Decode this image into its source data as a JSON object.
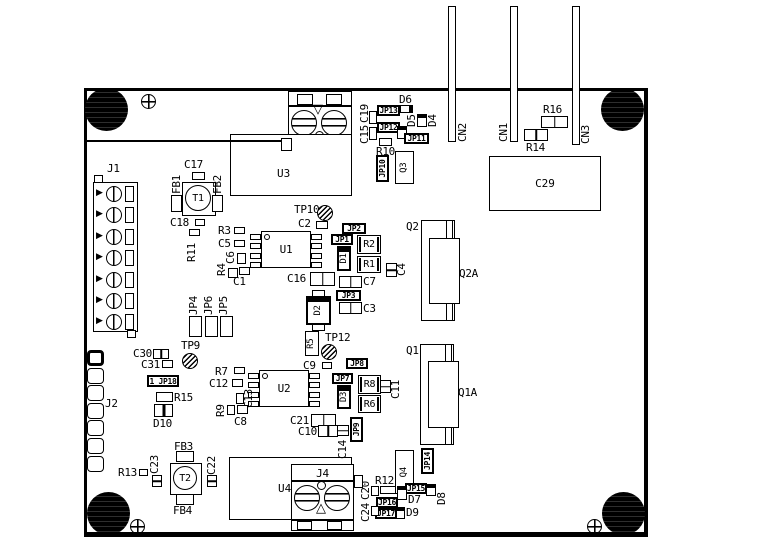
{
  "title": "PCB assembly drawing",
  "colors": {
    "ink": "#000000",
    "background": "#ffffff"
  },
  "designators": {
    "j1": "J1",
    "j2": "J2",
    "j3": "J3",
    "j4": "J4",
    "u1": "U1",
    "u2": "U2",
    "u3": "U3",
    "u4": "U4",
    "t1": "T1",
    "t2": "T2",
    "c29": "C29"
  },
  "parts": [
    {
      "n": "trace-to-j3",
      "k": "hline",
      "x": 84,
      "y": 140,
      "w": 198,
      "h": 2
    },
    {
      "n": "cn2-pin",
      "k": "rect",
      "x": 448,
      "y": 6,
      "w": 8,
      "h": 136
    },
    {
      "n": "cn2-label",
      "k": "vlbl",
      "t": "CN2",
      "x": 457,
      "y": 118,
      "w": 11,
      "h": 24
    },
    {
      "n": "cn1-pin",
      "k": "rect",
      "x": 510,
      "y": 6,
      "w": 8,
      "h": 136
    },
    {
      "n": "cn1-label",
      "k": "vlbl",
      "t": "CN1",
      "x": 498,
      "y": 118,
      "w": 11,
      "h": 24
    },
    {
      "n": "cn3-pin",
      "k": "rect",
      "x": 572,
      "y": 6,
      "w": 8,
      "h": 139
    },
    {
      "n": "cn3-label",
      "k": "vlbl",
      "t": "CN3",
      "x": 580,
      "y": 120,
      "w": 11,
      "h": 24
    },
    {
      "n": "r16-label",
      "k": "lbl",
      "t": "R16",
      "x": 543,
      "y": 104
    },
    {
      "n": "r16-body",
      "k": "cap",
      "x": 541,
      "y": 116,
      "w": 27,
      "h": 12
    },
    {
      "n": "r14-body",
      "k": "cap",
      "x": 524,
      "y": 129,
      "w": 24,
      "h": 12
    },
    {
      "n": "r14-label",
      "k": "lbl",
      "t": "R14",
      "x": 526,
      "y": 142
    },
    {
      "n": "c19-label",
      "k": "vlbl",
      "t": "C19",
      "x": 359,
      "y": 103,
      "w": 11,
      "h": 20
    },
    {
      "n": "c15-label",
      "k": "vlbl",
      "t": "C15",
      "x": 359,
      "y": 124,
      "w": 11,
      "h": 20
    },
    {
      "n": "c19-body",
      "k": "rect",
      "x": 369,
      "y": 111,
      "w": 8,
      "h": 13
    },
    {
      "n": "c15-body",
      "k": "rect",
      "x": 369,
      "y": 127,
      "w": 8,
      "h": 13
    },
    {
      "n": "jp13",
      "k": "jp",
      "t": "JP13",
      "x": 377,
      "y": 105,
      "w": 23,
      "h": 11
    },
    {
      "n": "jp12",
      "k": "jp",
      "t": "JP12",
      "x": 377,
      "y": 122,
      "w": 23,
      "h": 11
    },
    {
      "n": "d6-label",
      "k": "lbl",
      "t": "D6",
      "x": 399,
      "y": 94
    },
    {
      "n": "d6-body",
      "k": "dih",
      "x": 400,
      "y": 105,
      "w": 13,
      "h": 8
    },
    {
      "n": "d5-body",
      "k": "di",
      "x": 397,
      "y": 126,
      "w": 10,
      "h": 13
    },
    {
      "n": "d5-label",
      "k": "vlbl",
      "t": "D5",
      "x": 406,
      "y": 111,
      "w": 11,
      "h": 16
    },
    {
      "n": "d4-body",
      "k": "di",
      "x": 417,
      "y": 114,
      "w": 10,
      "h": 13
    },
    {
      "n": "d4-label",
      "k": "vlbl",
      "t": "D4",
      "x": 427,
      "y": 111,
      "w": 11,
      "h": 16
    },
    {
      "n": "jp11",
      "k": "jp",
      "t": "JP11",
      "x": 404,
      "y": 133,
      "w": 25,
      "h": 11
    },
    {
      "n": "r10-body",
      "k": "rect",
      "x": 379,
      "y": 138,
      "w": 13,
      "h": 8
    },
    {
      "n": "r10-label",
      "k": "lbl",
      "t": "R10",
      "x": 376,
      "y": 146
    },
    {
      "n": "jp10",
      "k": "vjp",
      "t": "JP10",
      "x": 376,
      "y": 155,
      "w": 13,
      "h": 27
    },
    {
      "n": "q3",
      "k": "vbox",
      "t": "Q3",
      "x": 395,
      "y": 151,
      "w": 19,
      "h": 33
    },
    {
      "n": "j3-pin-left",
      "k": "rect",
      "x": 281,
      "y": 138,
      "w": 11,
      "h": 13
    },
    {
      "n": "c17-label",
      "k": "lbl",
      "t": "C17",
      "x": 184,
      "y": 159
    },
    {
      "n": "c17-body",
      "k": "rect",
      "x": 192,
      "y": 172,
      "w": 13,
      "h": 8
    },
    {
      "n": "fb1-label",
      "k": "vlbl",
      "t": "FB1",
      "x": 171,
      "y": 170,
      "w": 11,
      "h": 24
    },
    {
      "n": "fb1-body",
      "k": "rect",
      "x": 171,
      "y": 195,
      "w": 11,
      "h": 17
    },
    {
      "n": "fb2-label",
      "k": "vlbl",
      "t": "FB2",
      "x": 212,
      "y": 170,
      "w": 11,
      "h": 24
    },
    {
      "n": "fb2-body",
      "k": "rect",
      "x": 212,
      "y": 195,
      "w": 11,
      "h": 17
    },
    {
      "n": "c18-label",
      "k": "lbl",
      "t": "C18",
      "x": 170,
      "y": 217
    },
    {
      "n": "c18-body",
      "k": "rect",
      "x": 195,
      "y": 219,
      "w": 10,
      "h": 7
    },
    {
      "n": "r11-body",
      "k": "rect",
      "x": 189,
      "y": 229,
      "w": 11,
      "h": 7
    },
    {
      "n": "r11-label",
      "k": "vlbl",
      "t": "R11",
      "x": 186,
      "y": 238,
      "w": 11,
      "h": 24
    },
    {
      "n": "j1-label",
      "k": "lbl",
      "t": "J1",
      "x": 107,
      "y": 163
    },
    {
      "n": "j1-stub-top",
      "k": "rect",
      "x": 94,
      "y": 175,
      "w": 9,
      "h": 8
    },
    {
      "n": "j1-stub-bottom",
      "k": "rect",
      "x": 127,
      "y": 330,
      "w": 9,
      "h": 8
    },
    {
      "n": "r3-label",
      "k": "lbl",
      "t": "R3",
      "x": 218,
      "y": 225
    },
    {
      "n": "r3-body",
      "k": "rect",
      "x": 234,
      "y": 227,
      "w": 11,
      "h": 7
    },
    {
      "n": "c5-label",
      "k": "lbl",
      "t": "C5",
      "x": 218,
      "y": 238
    },
    {
      "n": "c5-body",
      "k": "rect",
      "x": 234,
      "y": 240,
      "w": 11,
      "h": 7
    },
    {
      "n": "c6-label",
      "k": "vlbl",
      "t": "C6",
      "x": 225,
      "y": 249,
      "w": 11,
      "h": 15
    },
    {
      "n": "c6-body",
      "k": "rect",
      "x": 237,
      "y": 253,
      "w": 9,
      "h": 11
    },
    {
      "n": "r4-label",
      "k": "vlbl",
      "t": "R4",
      "x": 216,
      "y": 261,
      "w": 11,
      "h": 15
    },
    {
      "n": "r4-body",
      "k": "rect",
      "x": 228,
      "y": 268,
      "w": 10,
      "h": 10
    },
    {
      "n": "c1-body",
      "k": "rect",
      "x": 239,
      "y": 267,
      "w": 11,
      "h": 8
    },
    {
      "n": "c1-label",
      "k": "lbl",
      "t": "C1",
      "x": 233,
      "y": 276
    },
    {
      "n": "jp4-label",
      "k": "vlbl",
      "t": "JP4",
      "x": 188,
      "y": 291,
      "w": 11,
      "h": 24
    },
    {
      "n": "jp6-label",
      "k": "vlbl",
      "t": "JP6",
      "x": 203,
      "y": 291,
      "w": 11,
      "h": 24
    },
    {
      "n": "jp5-label",
      "k": "vlbl",
      "t": "JP5",
      "x": 218,
      "y": 291,
      "w": 11,
      "h": 24
    },
    {
      "n": "jp4-body",
      "k": "rect",
      "x": 189,
      "y": 316,
      "w": 13,
      "h": 21
    },
    {
      "n": "jp6-body",
      "k": "rect",
      "x": 205,
      "y": 316,
      "w": 13,
      "h": 21
    },
    {
      "n": "jp5-body",
      "k": "rect",
      "x": 220,
      "y": 316,
      "w": 13,
      "h": 21
    },
    {
      "n": "tp10-label",
      "k": "lbl",
      "t": "TP10",
      "x": 294,
      "y": 204
    },
    {
      "n": "tp10",
      "k": "tp",
      "x": 317,
      "y": 205,
      "w": 16,
      "h": 16
    },
    {
      "n": "c2-label",
      "k": "lbl",
      "t": "C2",
      "x": 298,
      "y": 218
    },
    {
      "n": "c2-body",
      "k": "rect",
      "x": 316,
      "y": 221,
      "w": 12,
      "h": 8
    },
    {
      "n": "jp2",
      "k": "jp",
      "t": "JP2",
      "x": 342,
      "y": 223,
      "w": 24,
      "h": 11
    },
    {
      "n": "jp1",
      "k": "jp",
      "t": "JP1",
      "x": 331,
      "y": 234,
      "w": 22,
      "h": 11
    },
    {
      "n": "r2",
      "k": "box",
      "t": "R2",
      "x": 357,
      "y": 235,
      "w": 24,
      "h": 19
    },
    {
      "n": "d1",
      "k": "dbox",
      "t": "D1",
      "x": 337,
      "y": 246,
      "w": 14,
      "h": 25
    },
    {
      "n": "r1",
      "k": "box",
      "t": "R1",
      "x": 357,
      "y": 256,
      "w": 24,
      "h": 17
    },
    {
      "n": "c4-body",
      "k": "vcap",
      "x": 386,
      "y": 263,
      "w": 11,
      "h": 14
    },
    {
      "n": "c4-label",
      "k": "vlbl",
      "t": "C4",
      "x": 396,
      "y": 260,
      "w": 11,
      "h": 16
    },
    {
      "n": "q2-label",
      "k": "lbl",
      "t": "Q2",
      "x": 406,
      "y": 221
    },
    {
      "n": "q2-body",
      "k": "rect",
      "x": 421,
      "y": 220,
      "w": 34,
      "h": 101
    },
    {
      "n": "q2-rails",
      "k": "rails",
      "x": 446,
      "y": 220,
      "w": 7,
      "h": 101
    },
    {
      "n": "q2a-body",
      "k": "rect",
      "x": 429,
      "y": 238,
      "w": 31,
      "h": 66
    },
    {
      "n": "q2a-label",
      "k": "lbl",
      "t": "Q2A",
      "x": 459,
      "y": 268
    },
    {
      "n": "c16-label",
      "k": "lbl",
      "t": "C16",
      "x": 287,
      "y": 273
    },
    {
      "n": "c16-body",
      "k": "cap",
      "x": 310,
      "y": 272,
      "w": 25,
      "h": 14
    },
    {
      "n": "c7-body",
      "k": "cap",
      "x": 339,
      "y": 276,
      "w": 23,
      "h": 12
    },
    {
      "n": "c7-label",
      "k": "lbl",
      "t": "C7",
      "x": 363,
      "y": 276
    },
    {
      "n": "jp3",
      "k": "jp",
      "t": "JP3",
      "x": 336,
      "y": 290,
      "w": 25,
      "h": 11
    },
    {
      "n": "c3-body",
      "k": "cap",
      "x": 339,
      "y": 302,
      "w": 23,
      "h": 12
    },
    {
      "n": "c3-label",
      "k": "lbl",
      "t": "C3",
      "x": 363,
      "y": 303
    },
    {
      "n": "d2-pad-top",
      "k": "rect",
      "x": 312,
      "y": 290,
      "w": 13,
      "h": 7
    },
    {
      "n": "d2",
      "k": "dbox",
      "t": "D2",
      "x": 306,
      "y": 296,
      "w": 25,
      "h": 29
    },
    {
      "n": "d2-pad-bottom",
      "k": "rect",
      "x": 312,
      "y": 324,
      "w": 13,
      "h": 7
    },
    {
      "n": "r5",
      "k": "vbox",
      "t": "R5",
      "x": 305,
      "y": 331,
      "w": 14,
      "h": 25
    },
    {
      "n": "tp12-label",
      "k": "lbl",
      "t": "TP12",
      "x": 325,
      "y": 332
    },
    {
      "n": "tp12",
      "k": "tp",
      "x": 321,
      "y": 344,
      "w": 16,
      "h": 16
    },
    {
      "n": "tp9-label",
      "k": "lbl",
      "t": "TP9",
      "x": 181,
      "y": 340
    },
    {
      "n": "tp9",
      "k": "tp",
      "x": 182,
      "y": 353,
      "w": 16,
      "h": 16
    },
    {
      "n": "c30-label",
      "k": "lbl",
      "t": "C30",
      "x": 133,
      "y": 348
    },
    {
      "n": "c30-body",
      "k": "cap",
      "x": 153,
      "y": 349,
      "w": 16,
      "h": 10
    },
    {
      "n": "c31-label",
      "k": "lbl",
      "t": "C31",
      "x": 141,
      "y": 359
    },
    {
      "n": "c31-body",
      "k": "rect",
      "x": 162,
      "y": 360,
      "w": 11,
      "h": 8
    },
    {
      "n": "jp18",
      "k": "jp",
      "t": "1 JP18",
      "x": 147,
      "y": 375,
      "w": 32,
      "h": 12
    },
    {
      "n": "r15-body",
      "k": "rect",
      "x": 156,
      "y": 392,
      "w": 17,
      "h": 10
    },
    {
      "n": "r15-label",
      "k": "lbl",
      "t": "R15",
      "x": 174,
      "y": 392
    },
    {
      "n": "d10-body",
      "k": "dcap",
      "x": 154,
      "y": 404,
      "w": 19,
      "h": 13
    },
    {
      "n": "d10-label",
      "k": "lbl",
      "t": "D10",
      "x": 153,
      "y": 418
    },
    {
      "n": "j2-label",
      "k": "lbl",
      "t": "J2",
      "x": 105,
      "y": 398
    },
    {
      "n": "r7-label",
      "k": "lbl",
      "t": "R7",
      "x": 215,
      "y": 366
    },
    {
      "n": "r7-body",
      "k": "rect",
      "x": 234,
      "y": 367,
      "w": 11,
      "h": 7
    },
    {
      "n": "c12-label",
      "k": "lbl",
      "t": "C12",
      "x": 209,
      "y": 378
    },
    {
      "n": "c12-body",
      "k": "rect",
      "x": 232,
      "y": 379,
      "w": 11,
      "h": 8
    },
    {
      "n": "c13-body",
      "k": "rect",
      "x": 236,
      "y": 393,
      "w": 8,
      "h": 11
    },
    {
      "n": "c13-label",
      "k": "vlbl",
      "t": "C13",
      "x": 243,
      "y": 386,
      "w": 11,
      "h": 22
    },
    {
      "n": "r9-label",
      "k": "vlbl",
      "t": "R9",
      "x": 215,
      "y": 402,
      "w": 11,
      "h": 15
    },
    {
      "n": "r9-body",
      "k": "rect",
      "x": 227,
      "y": 405,
      "w": 8,
      "h": 10
    },
    {
      "n": "c8-body",
      "k": "rect",
      "x": 237,
      "y": 405,
      "w": 11,
      "h": 9
    },
    {
      "n": "c8-label",
      "k": "lbl",
      "t": "C8",
      "x": 234,
      "y": 416
    },
    {
      "n": "c9-label",
      "k": "lbl",
      "t": "C9",
      "x": 303,
      "y": 360
    },
    {
      "n": "c9-body",
      "k": "rect",
      "x": 322,
      "y": 362,
      "w": 10,
      "h": 7
    },
    {
      "n": "jp8",
      "k": "jp",
      "t": "JP8",
      "x": 346,
      "y": 358,
      "w": 22,
      "h": 11
    },
    {
      "n": "jp7",
      "k": "jp",
      "t": "JP7",
      "x": 332,
      "y": 373,
      "w": 21,
      "h": 11
    },
    {
      "n": "r8",
      "k": "box",
      "t": "R8",
      "x": 358,
      "y": 375,
      "w": 23,
      "h": 19
    },
    {
      "n": "d3",
      "k": "dbox",
      "t": "D3",
      "x": 337,
      "y": 385,
      "w": 14,
      "h": 24
    },
    {
      "n": "r6",
      "k": "box",
      "t": "R6",
      "x": 358,
      "y": 395,
      "w": 23,
      "h": 18
    },
    {
      "n": "c11-body",
      "k": "vcap",
      "x": 380,
      "y": 380,
      "w": 11,
      "h": 13
    },
    {
      "n": "c11-label",
      "k": "vlbl",
      "t": "C11",
      "x": 390,
      "y": 379,
      "w": 11,
      "h": 20
    },
    {
      "n": "q1-label",
      "k": "lbl",
      "t": "Q1",
      "x": 406,
      "y": 345
    },
    {
      "n": "q1-body",
      "k": "rect",
      "x": 420,
      "y": 344,
      "w": 34,
      "h": 101
    },
    {
      "n": "q1-rails",
      "k": "rails",
      "x": 445,
      "y": 344,
      "w": 7,
      "h": 101
    },
    {
      "n": "q1a-body",
      "k": "rect",
      "x": 428,
      "y": 361,
      "w": 31,
      "h": 67
    },
    {
      "n": "q1a-label",
      "k": "lbl",
      "t": "Q1A",
      "x": 458,
      "y": 387
    },
    {
      "n": "c21-label",
      "k": "lbl",
      "t": "C21",
      "x": 290,
      "y": 415
    },
    {
      "n": "c21-body",
      "k": "cap",
      "x": 311,
      "y": 414,
      "w": 25,
      "h": 13
    },
    {
      "n": "c10-label",
      "k": "lbl",
      "t": "C10",
      "x": 298,
      "y": 426
    },
    {
      "n": "c10-body",
      "k": "cap",
      "x": 318,
      "y": 425,
      "w": 20,
      "h": 12
    },
    {
      "n": "c14-body",
      "k": "vcap",
      "x": 337,
      "y": 425,
      "w": 12,
      "h": 11
    },
    {
      "n": "c14-label",
      "k": "vlbl",
      "t": "C14",
      "x": 337,
      "y": 437,
      "w": 11,
      "h": 22
    },
    {
      "n": "jp9",
      "k": "vjp",
      "t": "JP9",
      "x": 350,
      "y": 417,
      "w": 13,
      "h": 25
    },
    {
      "n": "q4",
      "k": "vbox",
      "t": "Q4",
      "x": 395,
      "y": 450,
      "w": 19,
      "h": 44
    },
    {
      "n": "jp14",
      "k": "vjp",
      "t": "JP14",
      "x": 421,
      "y": 448,
      "w": 13,
      "h": 26
    },
    {
      "n": "r12-label",
      "k": "lbl",
      "t": "R12",
      "x": 375,
      "y": 475
    },
    {
      "n": "r12-body",
      "k": "rect",
      "x": 380,
      "y": 486,
      "w": 16,
      "h": 8
    },
    {
      "n": "jp15",
      "k": "jp",
      "t": "JP15",
      "x": 405,
      "y": 483,
      "w": 22,
      "h": 11
    },
    {
      "n": "d7-body",
      "k": "di",
      "x": 397,
      "y": 486,
      "w": 10,
      "h": 14
    },
    {
      "n": "d7-label",
      "k": "lbl",
      "t": "D7",
      "x": 408,
      "y": 494
    },
    {
      "n": "d8-body",
      "k": "di",
      "x": 426,
      "y": 484,
      "w": 10,
      "h": 12
    },
    {
      "n": "d8-label",
      "k": "vlbl",
      "t": "D8",
      "x": 436,
      "y": 488,
      "w": 11,
      "h": 17
    },
    {
      "n": "jp16",
      "k": "jp",
      "t": "JP16",
      "x": 376,
      "y": 497,
      "w": 22,
      "h": 11
    },
    {
      "n": "d9-body",
      "k": "di",
      "x": 396,
      "y": 507,
      "w": 9,
      "h": 12
    },
    {
      "n": "d9-label",
      "k": "lbl",
      "t": "D9",
      "x": 406,
      "y": 507
    },
    {
      "n": "jp17",
      "k": "jp",
      "t": "JP17",
      "x": 375,
      "y": 508,
      "w": 22,
      "h": 11
    },
    {
      "n": "c20-label",
      "k": "vlbl",
      "t": "C20",
      "x": 360,
      "y": 479,
      "w": 11,
      "h": 21
    },
    {
      "n": "c20-body",
      "k": "rect",
      "x": 371,
      "y": 486,
      "w": 8,
      "h": 10
    },
    {
      "n": "c24-label",
      "k": "vlbl",
      "t": "C24",
      "x": 360,
      "y": 501,
      "w": 11,
      "h": 21
    },
    {
      "n": "c24-body",
      "k": "rect",
      "x": 371,
      "y": 506,
      "w": 8,
      "h": 10
    },
    {
      "n": "j4-pin-right",
      "k": "rect",
      "x": 354,
      "y": 475,
      "w": 9,
      "h": 13
    },
    {
      "n": "c23-label",
      "k": "vlbl",
      "t": "C23",
      "x": 149,
      "y": 450,
      "w": 11,
      "h": 24
    },
    {
      "n": "c23-body",
      "k": "vcap",
      "x": 152,
      "y": 475,
      "w": 10,
      "h": 12
    },
    {
      "n": "c22-label",
      "k": "vlbl",
      "t": "C22",
      "x": 206,
      "y": 451,
      "w": 11,
      "h": 24
    },
    {
      "n": "c22-body",
      "k": "vcap",
      "x": 207,
      "y": 475,
      "w": 10,
      "h": 12
    },
    {
      "n": "r13-label",
      "k": "lbl",
      "t": "R13",
      "x": 118,
      "y": 467
    },
    {
      "n": "r13-body",
      "k": "rect",
      "x": 139,
      "y": 469,
      "w": 9,
      "h": 7
    },
    {
      "n": "fb3-label",
      "k": "lbl",
      "t": "FB3",
      "x": 174,
      "y": 441
    },
    {
      "n": "fb3-body",
      "k": "rect",
      "x": 176,
      "y": 451,
      "w": 18,
      "h": 11
    },
    {
      "n": "fb4-body",
      "k": "rect",
      "x": 176,
      "y": 494,
      "w": 18,
      "h": 11
    },
    {
      "n": "fb4-label",
      "k": "lbl",
      "t": "FB4",
      "x": 173,
      "y": 505
    }
  ]
}
